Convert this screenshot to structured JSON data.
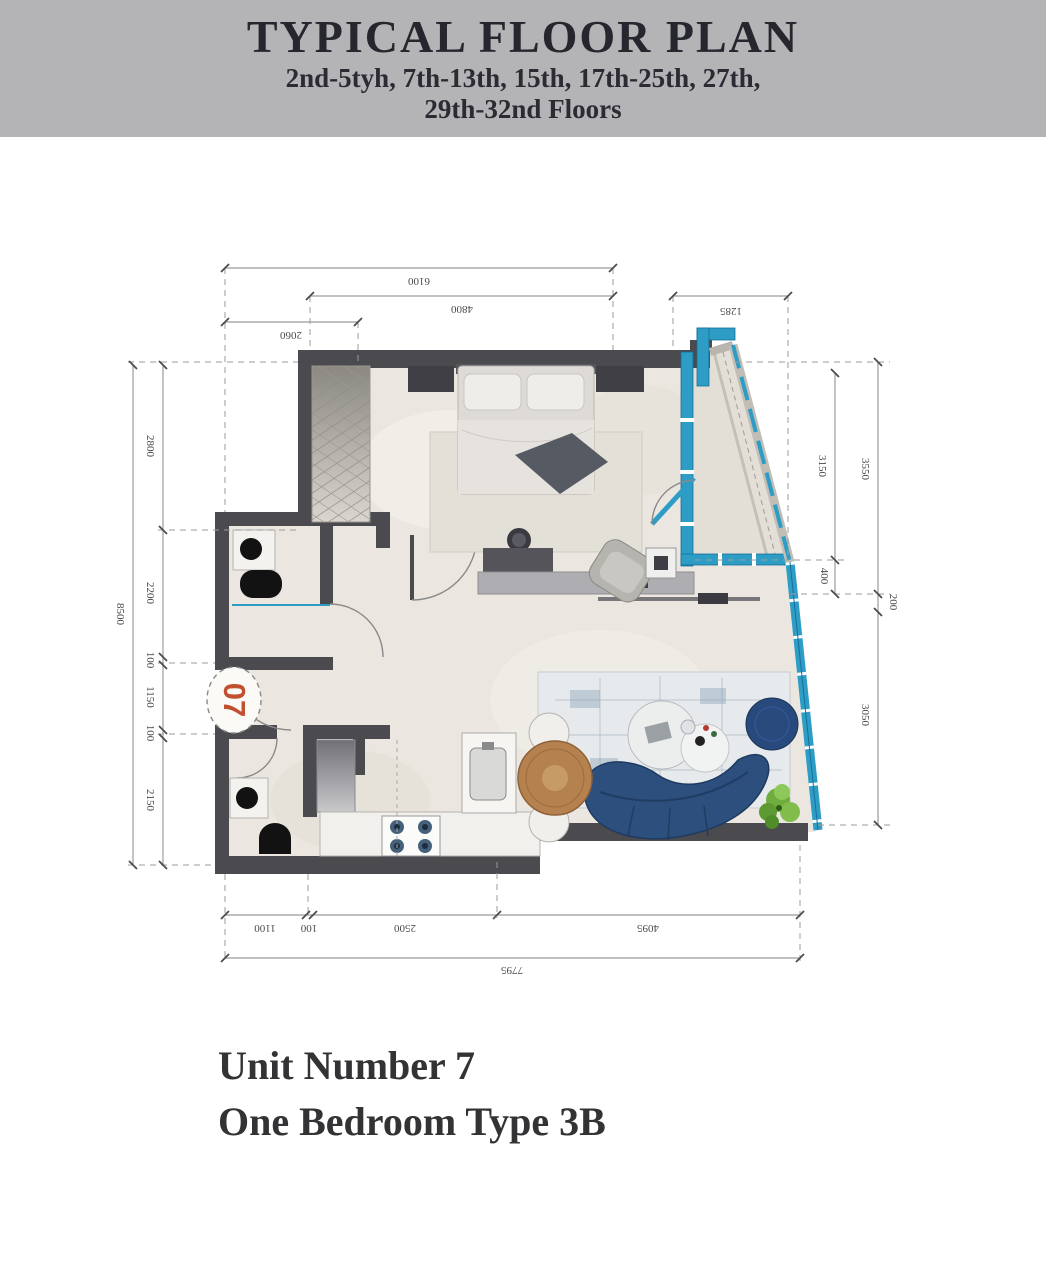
{
  "header": {
    "title": "TYPICAL FLOOR PLAN",
    "subtitle_line1": "2nd-5tyh, 7th-13th, 15th, 17th-25th, 27th,",
    "subtitle_line2": "29th-32nd  Floors"
  },
  "plan": {
    "unit_number_badge": "07",
    "dims": {
      "top_total": "6100",
      "top_main": "4800",
      "top_right": "1285",
      "top_left": "2060",
      "left_total": "8500",
      "left_segments": [
        "2800",
        "2200",
        "100",
        "1150",
        "100",
        "2150"
      ],
      "right_inner_segments": [
        "3150",
        "400"
      ],
      "right_outer_segments": [
        "3550",
        "200",
        "3050"
      ],
      "bottom_segments": [
        "1100",
        "100",
        "2500",
        "4095"
      ],
      "bottom_total": "7795"
    }
  },
  "footer": {
    "line1": "Unit Number 7",
    "line2": "One Bedroom Type 3B"
  },
  "colors": {
    "header_bg": "#b4b4b6",
    "wall": "#4a4a4f",
    "glass": "#2d9dc6",
    "sofa": "#2d4f7e",
    "unit_badge_red": "#c0502f"
  }
}
